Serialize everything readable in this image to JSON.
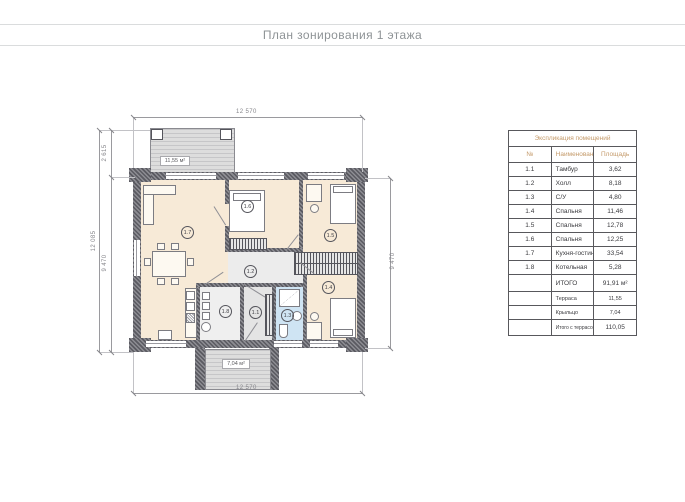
{
  "page": {
    "title": "План зонирования 1 этажа"
  },
  "plan": {
    "area_labels": {
      "terrace": "11,55 м²",
      "porch": "7,04 м²"
    },
    "dimensions": {
      "top": "12 570",
      "bottom": "12 570",
      "left_outer": "12 085",
      "left_upper": "2 615",
      "left_lower": "9 470",
      "right": "9 470"
    },
    "rooms": [
      {
        "label": "1.7"
      },
      {
        "label": "1.6"
      },
      {
        "label": "1.5"
      },
      {
        "label": "1.2"
      },
      {
        "label": "1.8"
      },
      {
        "label": "1.1"
      },
      {
        "label": "1.3"
      },
      {
        "label": "1.4"
      }
    ]
  },
  "legend": {
    "title": "Экспликация помещений",
    "columns": [
      "№",
      "Наименование",
      "Площадь"
    ],
    "rows": [
      [
        "1.1",
        "Тамбур",
        "3,62"
      ],
      [
        "1.2",
        "Холл",
        "8,18"
      ],
      [
        "1.3",
        "С/У",
        "4,80"
      ],
      [
        "1.4",
        "Спальня",
        "11,46"
      ],
      [
        "1.5",
        "Спальня",
        "12,78"
      ],
      [
        "1.6",
        "Спальня",
        "12,25"
      ],
      [
        "1.7",
        "Кухня-гостиная",
        "33,54"
      ],
      [
        "1.8",
        "Котельная",
        "5,28"
      ]
    ],
    "total_row": {
      "name": "ИТОГО",
      "value": "91,91 м²"
    },
    "extra_rows": [
      [
        "Терраса",
        "11,55"
      ],
      [
        "Крыльцо",
        "7,04"
      ]
    ],
    "grand_total": {
      "name": "Итого с террасой и крыльцом",
      "value": "110,05"
    }
  },
  "colors": {
    "accent_tan": "#c49a6a",
    "wall_dark": "#5a5a61",
    "room_beige": "#f7ead7",
    "room_gray": "#eaeaea",
    "bath_blue": "#cfe4f3",
    "title_gray": "#8e9396"
  }
}
